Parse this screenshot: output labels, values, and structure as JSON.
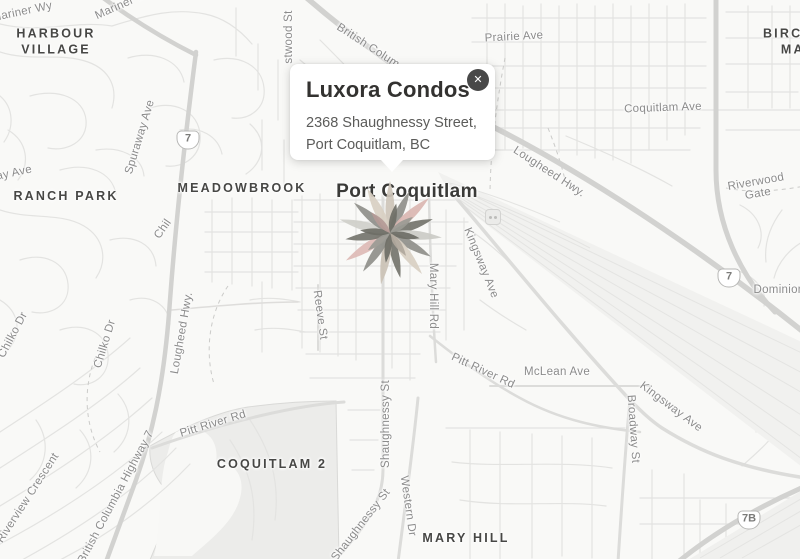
{
  "popup": {
    "title": "Luxora Condos",
    "address_line1": "2368 Shaughnessy Street,",
    "address_line2": "Port Coquitlam, BC",
    "close_icon": "✕"
  },
  "marker": {
    "kind": "flower-starburst",
    "cx": 390,
    "cy": 233,
    "petals": [
      [
        0,
        52,
        12,
        "#cdc4b8"
      ],
      [
        25,
        46,
        11,
        "#8f8f8a"
      ],
      [
        48,
        52,
        12,
        "#dab6b1"
      ],
      [
        72,
        45,
        11,
        "#74746c"
      ],
      [
        95,
        52,
        12,
        "#cbcbc6"
      ],
      [
        120,
        47,
        11,
        "#8f8f8a"
      ],
      [
        142,
        52,
        12,
        "#d8cfc2"
      ],
      [
        167,
        46,
        11,
        "#74746c"
      ],
      [
        190,
        52,
        12,
        "#cbc2b6"
      ],
      [
        215,
        47,
        11,
        "#8f8f8a"
      ],
      [
        238,
        52,
        12,
        "#ddbab5"
      ],
      [
        262,
        45,
        11,
        "#74746c"
      ],
      [
        285,
        52,
        12,
        "#cfcfca"
      ],
      [
        310,
        47,
        11,
        "#8f8f8a"
      ],
      [
        333,
        50,
        12,
        "#d8cfc2"
      ],
      [
        12,
        30,
        9,
        "#6e6e66"
      ],
      [
        55,
        28,
        9,
        "#9a9a94"
      ],
      [
        100,
        30,
        9,
        "#6e6e66"
      ],
      [
        145,
        28,
        9,
        "#b0a79c"
      ],
      [
        188,
        30,
        9,
        "#6e6e66"
      ],
      [
        232,
        28,
        9,
        "#9a9a94"
      ],
      [
        275,
        30,
        9,
        "#6e6e66"
      ],
      [
        318,
        28,
        9,
        "#b49a96"
      ]
    ]
  },
  "map": {
    "colors": {
      "background": "#f9f9f7",
      "road_major": "#d2d2d0",
      "road_minor": "#e3e3e1",
      "area_fill": "#ececea",
      "railyard_fill": "#f1f1ef",
      "street_label": "#8b8b8b",
      "area_label": "#474745"
    },
    "shields": [
      {
        "text": "7",
        "x": 188,
        "y": 140
      },
      {
        "text": "7",
        "x": 729,
        "y": 278
      },
      {
        "text": "7B",
        "x": 749,
        "y": 520
      }
    ],
    "transit_icon": {
      "x": 492,
      "y": 216
    },
    "labels": [
      {
        "text": "Port Coquitlam",
        "x": 407,
        "y": 192,
        "rot": 0,
        "type": "city"
      },
      {
        "text": "HARBOUR\nVILLAGE",
        "x": 56,
        "y": 42,
        "rot": 0,
        "type": "area"
      },
      {
        "text": "RANCH PARK",
        "x": 66,
        "y": 197,
        "rot": 0,
        "type": "area"
      },
      {
        "text": "MEADOWBROOK",
        "x": 242,
        "y": 189,
        "rot": 0,
        "type": "area"
      },
      {
        "text": "BIRCHLAND\nMANOR",
        "x": 810,
        "y": 42,
        "rot": 0,
        "type": "area"
      },
      {
        "text": "COQUITLAM 2",
        "x": 272,
        "y": 465,
        "rot": 0,
        "type": "area"
      },
      {
        "text": "MARY HILL",
        "x": 466,
        "y": 539,
        "rot": 0,
        "type": "area"
      },
      {
        "text": "Mariner Wy",
        "x": 22,
        "y": 12,
        "rot": -12,
        "type": "street"
      },
      {
        "text": "Mariner Wy",
        "x": 124,
        "y": 4,
        "rot": -24,
        "type": "street"
      },
      {
        "text": "Spuraway Ave",
        "x": 140,
        "y": 137,
        "rot": -73,
        "type": "street"
      },
      {
        "text": "way Ave",
        "x": 10,
        "y": 174,
        "rot": -12,
        "type": "street"
      },
      {
        "text": "stwood St",
        "x": 289,
        "y": 37,
        "rot": -90,
        "type": "street"
      },
      {
        "text": "British Colum",
        "x": 368,
        "y": 46,
        "rot": 33,
        "type": "street"
      },
      {
        "text": "Prairie Ave",
        "x": 514,
        "y": 37,
        "rot": -3,
        "type": "street"
      },
      {
        "text": "Coquitlam Ave",
        "x": 663,
        "y": 108,
        "rot": -2,
        "type": "street"
      },
      {
        "text": "Lougheed Hwy.",
        "x": 549,
        "y": 172,
        "rot": 33,
        "type": "street"
      },
      {
        "text": "Riverwood Gate",
        "x": 757,
        "y": 188,
        "rot": -10,
        "type": "street"
      },
      {
        "text": "Dominion",
        "x": 779,
        "y": 290,
        "rot": 0,
        "type": "street"
      },
      {
        "text": "Chil",
        "x": 163,
        "y": 229,
        "rot": -55,
        "type": "street"
      },
      {
        "text": "Chilko Dr",
        "x": 13,
        "y": 335,
        "rot": -62,
        "type": "street"
      },
      {
        "text": "Chilko Dr",
        "x": 105,
        "y": 344,
        "rot": -73,
        "type": "street"
      },
      {
        "text": "Lougheed Hwy.",
        "x": 182,
        "y": 333,
        "rot": -80,
        "type": "street"
      },
      {
        "text": "Kingsway Ave",
        "x": 481,
        "y": 263,
        "rot": 68,
        "type": "street"
      },
      {
        "text": "Mary Hill Rd",
        "x": 433,
        "y": 296,
        "rot": 90,
        "type": "street"
      },
      {
        "text": "Reeve St",
        "x": 320,
        "y": 315,
        "rot": 82,
        "type": "street"
      },
      {
        "text": "Shaughnessy St",
        "x": 386,
        "y": 424,
        "rot": -90,
        "type": "street"
      },
      {
        "text": "Pitt River Rd",
        "x": 483,
        "y": 371,
        "rot": 25,
        "type": "street"
      },
      {
        "text": "McLean Ave",
        "x": 557,
        "y": 372,
        "rot": 0,
        "type": "street"
      },
      {
        "text": "Kingsway Ave",
        "x": 671,
        "y": 407,
        "rot": 37,
        "type": "street"
      },
      {
        "text": "Broadway St",
        "x": 633,
        "y": 429,
        "rot": 86,
        "type": "street"
      },
      {
        "text": "Pitt River Rd",
        "x": 213,
        "y": 424,
        "rot": -17,
        "type": "street"
      },
      {
        "text": "Riverview Crescent",
        "x": 28,
        "y": 498,
        "rot": -57,
        "type": "street"
      },
      {
        "text": "British Columbia Highway 7",
        "x": 116,
        "y": 497,
        "rot": -62,
        "type": "street"
      },
      {
        "text": "Shaughnessy St",
        "x": 361,
        "y": 525,
        "rot": -52,
        "type": "street"
      },
      {
        "text": "Western Dr",
        "x": 408,
        "y": 506,
        "rot": 82,
        "type": "street"
      }
    ]
  }
}
